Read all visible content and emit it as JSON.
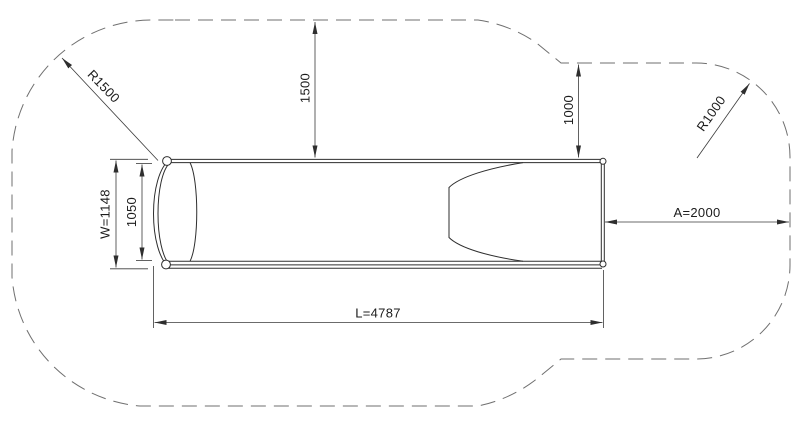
{
  "drawing": {
    "title": "slide-top-view-dimension-drawing",
    "colors": {
      "background": "#ffffff",
      "object_line": "#2e2e2e",
      "dimension_line": "#3a3a3a",
      "safety_zone_dash": "#6f6f6f",
      "text": "#1c1c1c"
    },
    "labels": {
      "radius_left": "R1500",
      "clearance_top": "1500",
      "clearance_top_right": "1000",
      "radius_right": "R1000",
      "overall_width": "W=1148",
      "inner_width": "1050",
      "side_clearance": "A=2000",
      "overall_length": "L=4787"
    }
  }
}
